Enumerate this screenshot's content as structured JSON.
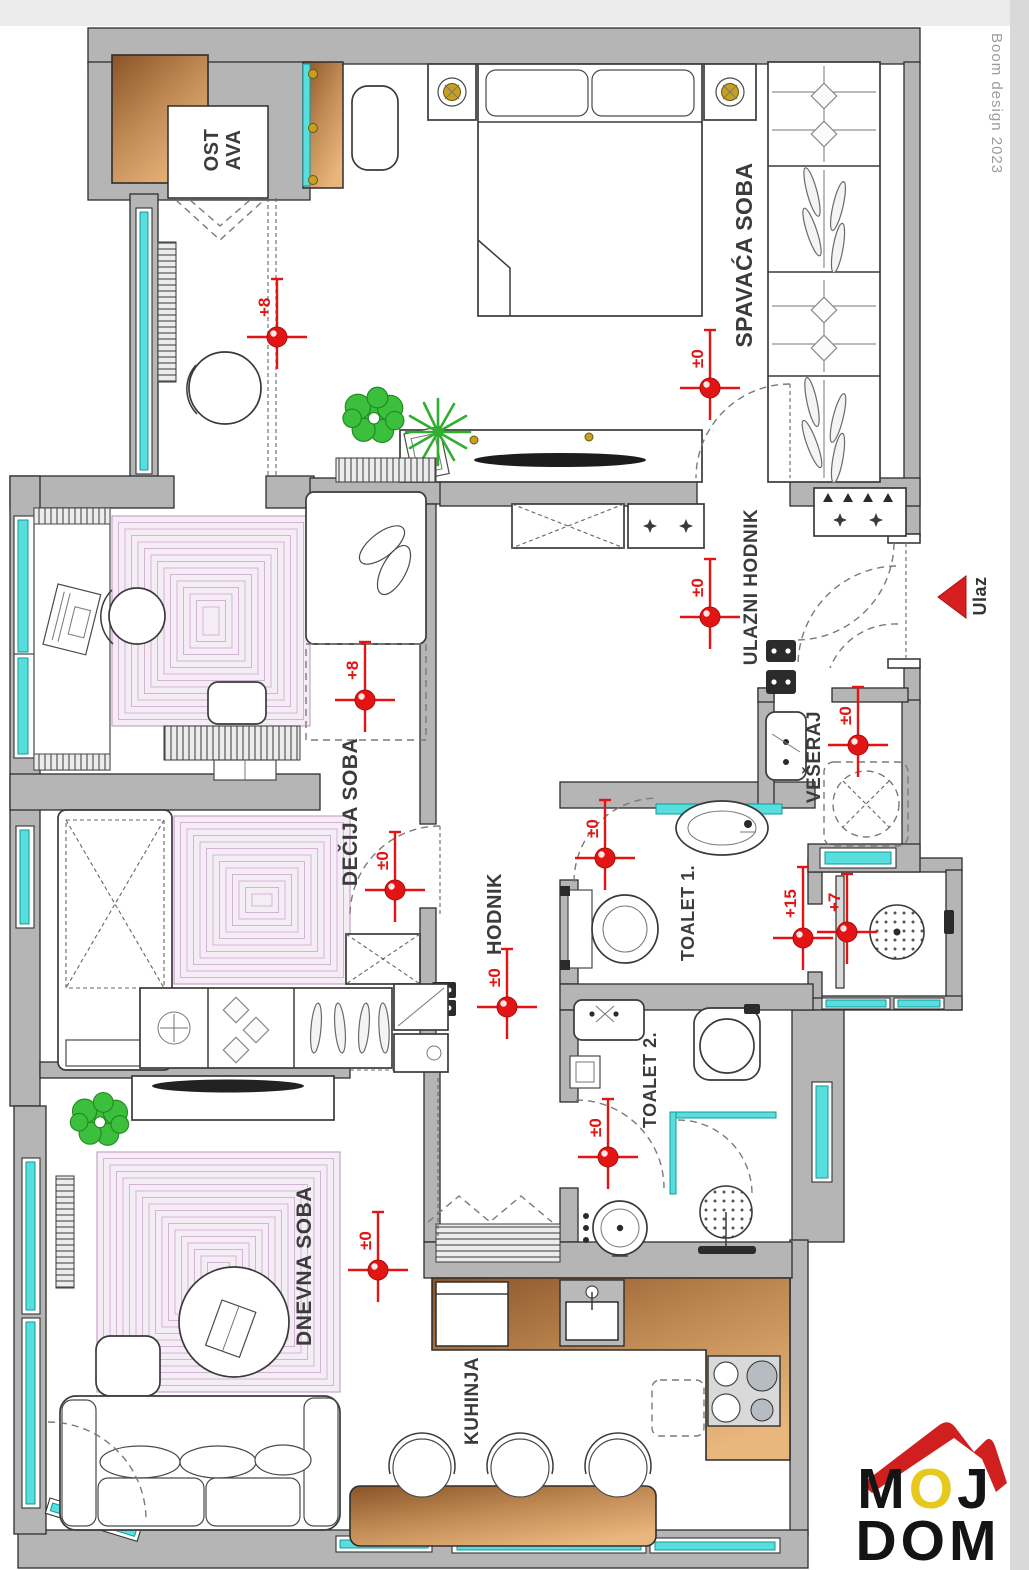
{
  "watermark": {
    "credit": "Boom design 2023"
  },
  "logo": {
    "line1": "MOJ",
    "line2": "DOM"
  },
  "entrance": {
    "label": "Ulaz"
  },
  "rooms": {
    "ostava_line1": "OST",
    "ostava_line2": "AVA",
    "spavaca": "SPAVAĆA SOBA",
    "ulazni_hodnik": "ULAZNI HODNIK",
    "decija": "DEČIJA SOBA",
    "hodnik": "HODNIK",
    "toalet1": "TOALET 1.",
    "veseraj": "VEŠERAJ",
    "toalet2": "TOALET 2.",
    "dnevna": "DNEVNA SOBA",
    "kuhinja": "KUHINJA"
  },
  "markers": [
    {
      "label": "+8",
      "x": 277,
      "y": 337
    },
    {
      "label": "±0",
      "x": 710,
      "y": 388
    },
    {
      "label": "±0",
      "x": 710,
      "y": 617
    },
    {
      "label": "+8",
      "x": 365,
      "y": 700
    },
    {
      "label": "±0",
      "x": 858,
      "y": 745
    },
    {
      "label": "±0",
      "x": 605,
      "y": 858
    },
    {
      "label": "±0",
      "x": 395,
      "y": 890
    },
    {
      "label": "+15",
      "x": 803,
      "y": 938
    },
    {
      "label": "+7",
      "x": 847,
      "y": 932
    },
    {
      "label": "±0",
      "x": 507,
      "y": 1007
    },
    {
      "label": "±0",
      "x": 608,
      "y": 1157
    },
    {
      "label": "±0",
      "x": 378,
      "y": 1270
    }
  ],
  "colors": {
    "wall_gray": "#b5b5b5",
    "window_cyan": "#58dedd",
    "marker_red": "#e21414",
    "rug_lavender": "#cfa8cf",
    "wood_brown": "#b97a45",
    "plant_green": "#3cbf3c",
    "lamp_gold": "#c7a01f",
    "logo_red": "#cf1f1f",
    "logo_yellow": "#e7c81d"
  }
}
